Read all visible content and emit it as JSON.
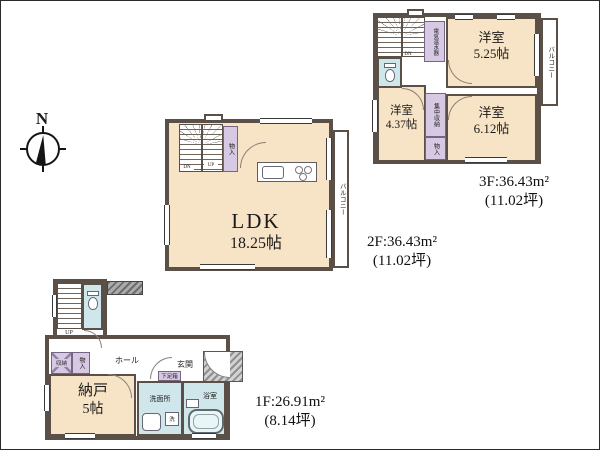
{
  "compass": {
    "north_label": "N"
  },
  "floor3": {
    "area_line1": "3F:36.43m²",
    "area_line2": "(11.02坪)",
    "room1_name": "洋室",
    "room1_size": "5.25帖",
    "room2_name": "洋室",
    "room2_size": "4.37帖",
    "room3_name": "洋室",
    "room3_size": "6.12帖",
    "balcony": "バルコニー",
    "water_heater": "電気温水器",
    "mid_closet": "集中収納",
    "closet": "物入",
    "stair_label": "DN"
  },
  "floor2": {
    "area_line1": "2F:36.43m²",
    "area_line2": "(11.02坪)",
    "ldk_name": "LDK",
    "ldk_size": "18.25帖",
    "balcony": "バルコニー",
    "closet": "物入",
    "stair_dn": "DN",
    "stair_up": "UP"
  },
  "floor1": {
    "area_line1": "1F:26.91m²",
    "area_line2": "(8.14坪)",
    "nando_name": "納戸",
    "nando_size": "5帖",
    "hall": "ホール",
    "entrance": "玄関",
    "shoe_box": "下足箱",
    "washroom": "洗面所",
    "bathroom": "浴室",
    "washer": "洗",
    "closet_a": "収納",
    "closet_b": "物入",
    "stair_label": "UP"
  },
  "colors": {
    "wall": "#5a5048",
    "room_cream": "#f7e3c5",
    "wet_blue": "#cfe7ea",
    "closet_lavender": "#d7c9e3"
  }
}
